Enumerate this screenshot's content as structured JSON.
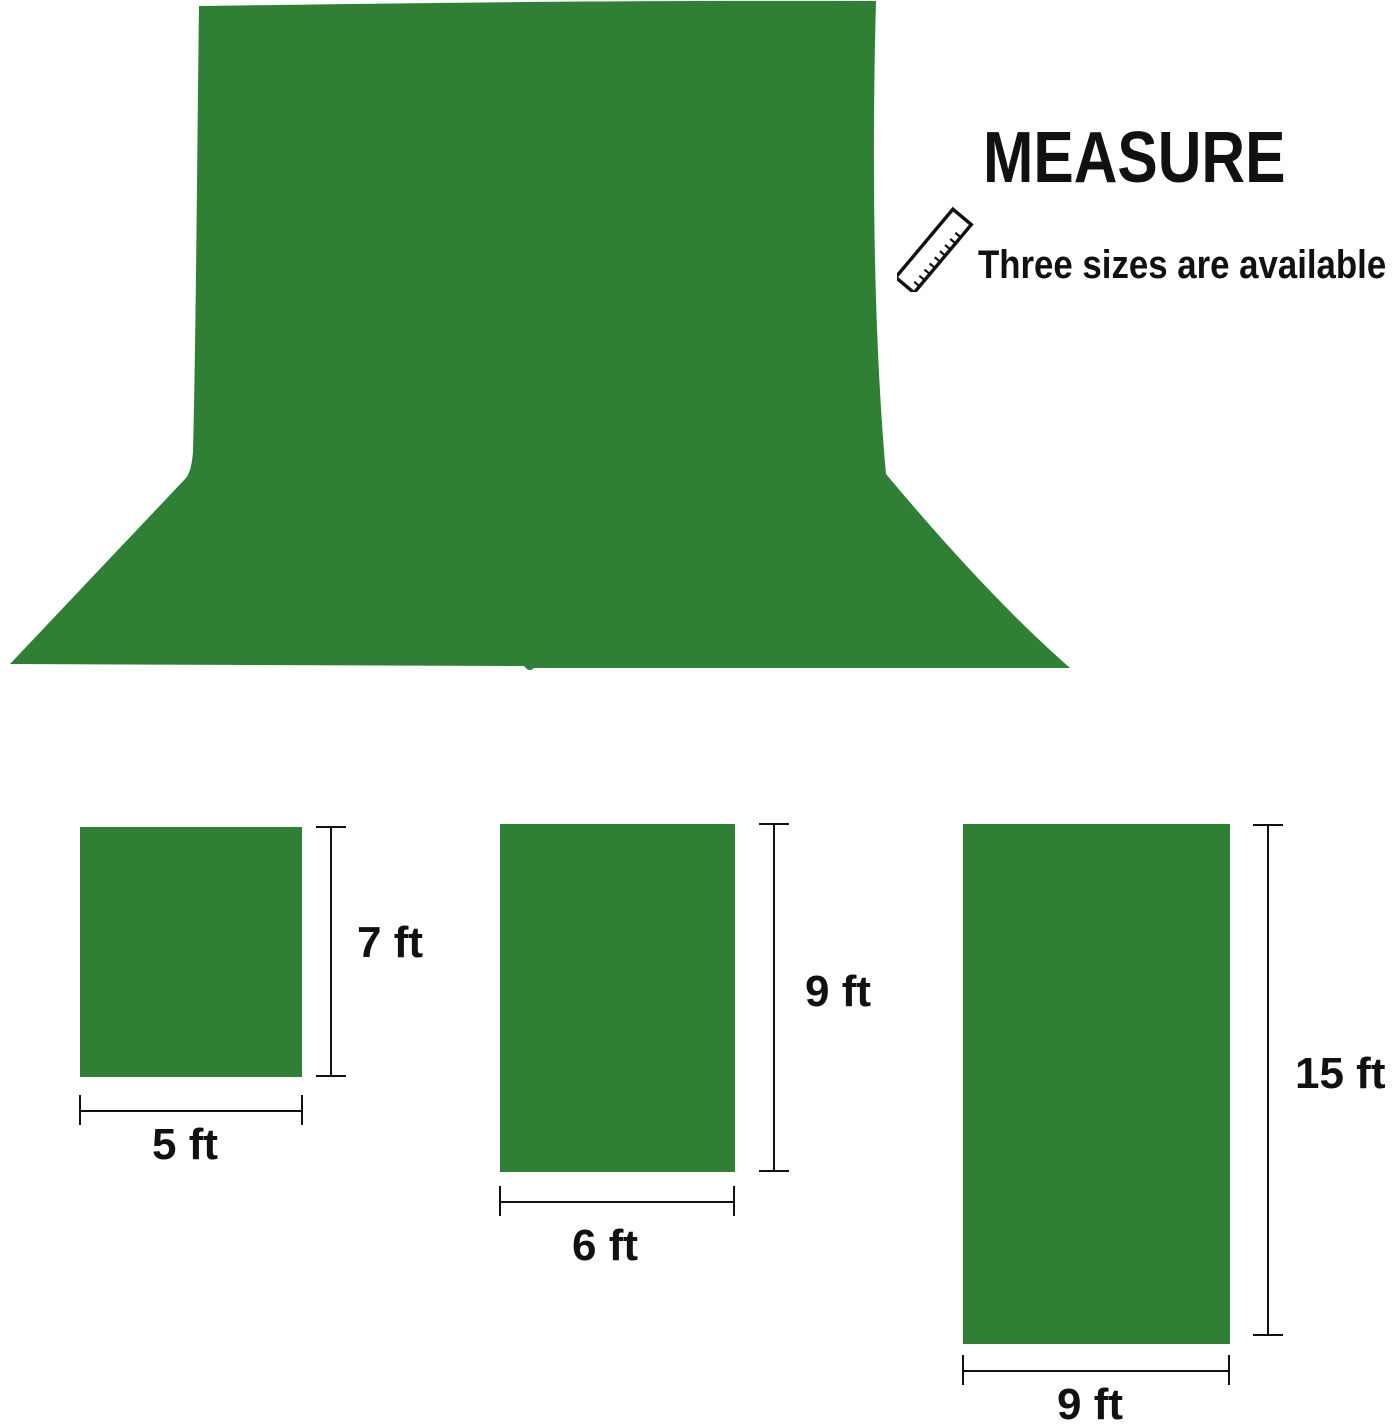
{
  "colors": {
    "green": "#2f8034",
    "ink": "#111111"
  },
  "header": {
    "title": "MEASURE",
    "subtitle": "Three sizes are available"
  },
  "icons": {
    "ruler": "ruler-icon"
  },
  "sizes": [
    {
      "width_label": "5 ft",
      "height_label": "7 ft"
    },
    {
      "width_label": "6 ft",
      "height_label": "9 ft"
    },
    {
      "width_label": "9 ft",
      "height_label": "15 ft"
    }
  ]
}
